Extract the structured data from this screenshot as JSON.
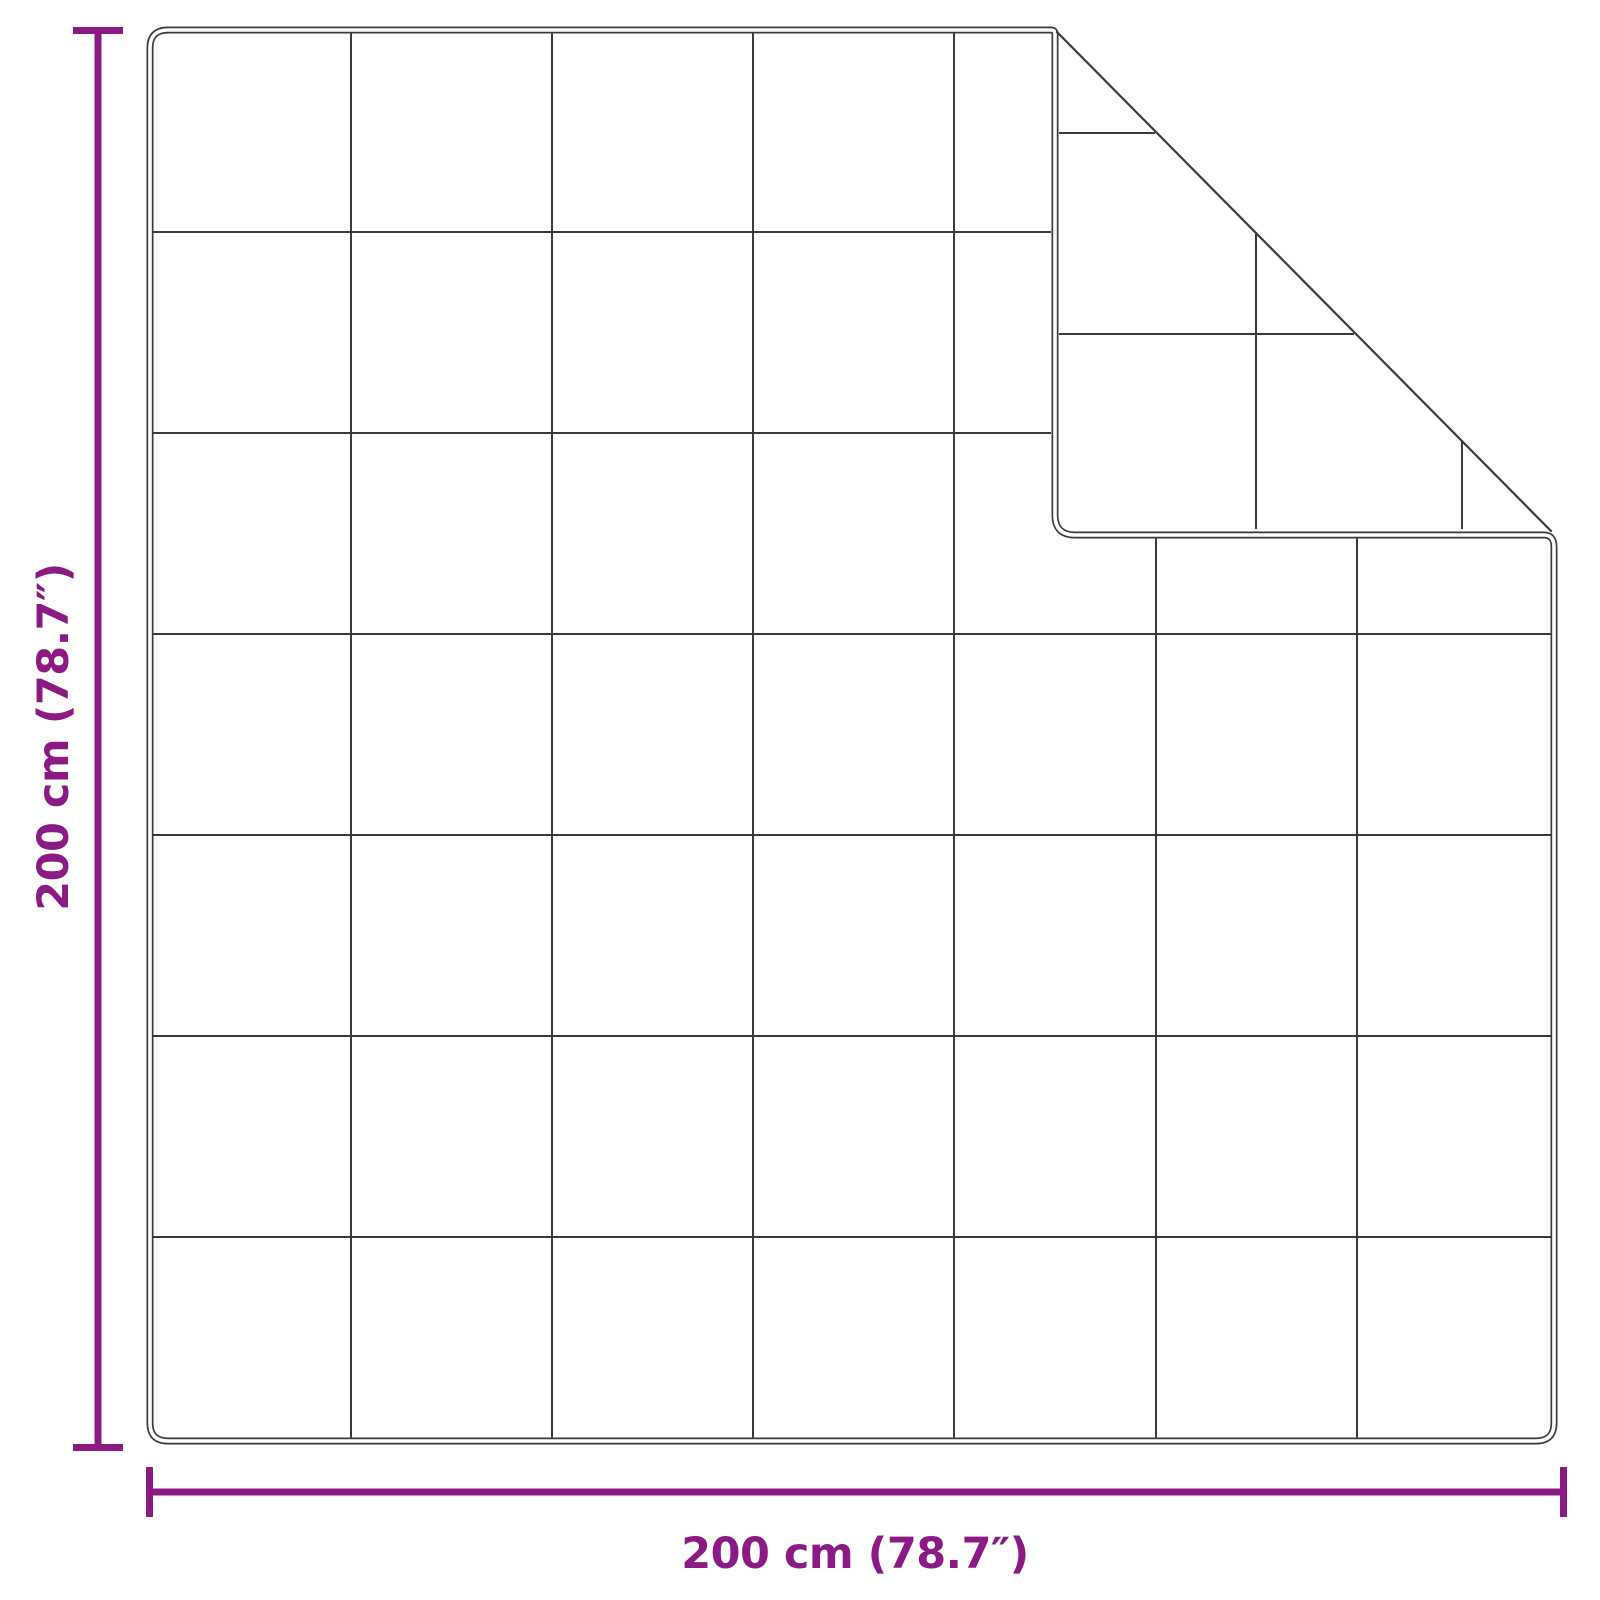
{
  "diagram": {
    "type": "product-dimension-diagram",
    "subject": "quilted-blanket-with-folded-corner",
    "grid": {
      "rows": 7,
      "columns": 7
    },
    "dimensions": {
      "width_label": "200 cm (78.7″)",
      "height_label": "200 cm (78.7″)"
    },
    "colors": {
      "dimension_accent": "#8B1A84",
      "outline": "#3a3a3a",
      "background": "#ffffff"
    }
  }
}
